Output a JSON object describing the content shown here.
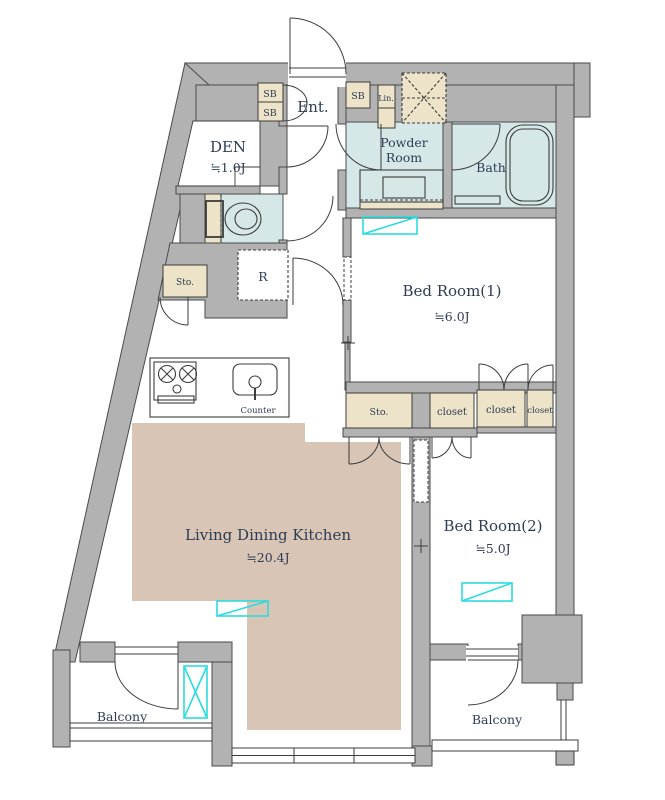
{
  "plan_title": "apartment-floor-plan",
  "colors": {
    "wall": "#b2b2b2",
    "water_room": "#d6e7e7",
    "storage": "#ece3c8",
    "wood_floor": "#d8c5b5",
    "ac_mark": "#2bdcdf",
    "line": "#3c3c3c",
    "text": "#2e3c54"
  },
  "labels": {
    "ent": "Ent.",
    "sb": "SB",
    "lin": "Lin.",
    "den": "DEN",
    "den_size": "≒1.0J",
    "powder_line1": "Powder",
    "powder_line2": "Room",
    "bath": "Bath",
    "bedroom1": "Bed Room(1)",
    "bedroom1_size": "≒6.0J",
    "bedroom2": "Bed Room(2)",
    "bedroom2_size": "≒5.0J",
    "ldk": "Living Dining Kitchen",
    "ldk_size": "≒20.4J",
    "sto": "Sto.",
    "r": "R",
    "counter": "Counter",
    "closet": "closet",
    "balcony": "Balcony"
  }
}
